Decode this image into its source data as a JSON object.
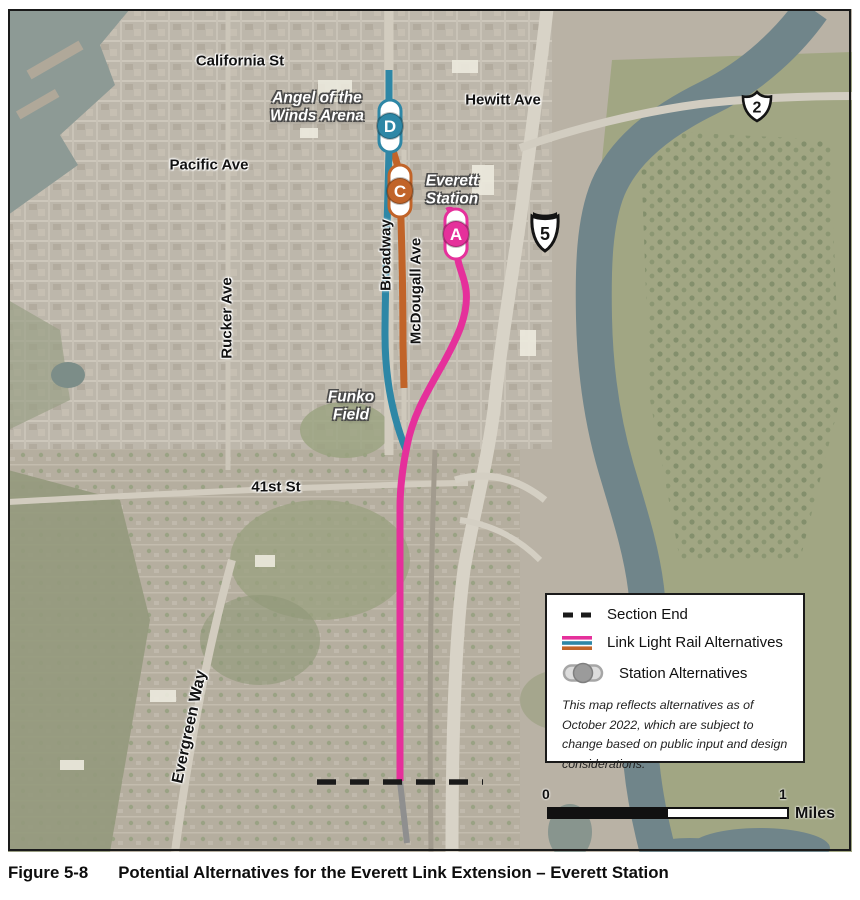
{
  "figure": {
    "label": "Figure 5-8",
    "title": "Potential Alternatives for the Everett Link Extension – Everett Station"
  },
  "map": {
    "street_labels": {
      "california_st": "California St",
      "hewitt_ave": "Hewitt Ave",
      "pacific_ave": "Pacific Ave",
      "rucker_ave": "Rucker Ave",
      "broadway": "Broadway",
      "mcdougall_ave": "McDougall Ave",
      "forty_first_st": "41st St",
      "evergreen_way": "Evergreen Way"
    },
    "place_labels": {
      "arena": {
        "line1": "Angel of the",
        "line2": "Winds Arena"
      },
      "everett_station": {
        "line1": "Everett",
        "line2": "Station"
      },
      "funko_field": {
        "line1": "Funko",
        "line2": "Field"
      }
    },
    "shields": {
      "us2": "2",
      "i5": "5"
    },
    "stations": [
      {
        "letter": "D",
        "color": "#2E87A6"
      },
      {
        "letter": "C",
        "color": "#C16429"
      },
      {
        "letter": "A",
        "color": "#E5309B"
      }
    ]
  },
  "legend": {
    "items": [
      {
        "label": "Section End"
      },
      {
        "label": "Link Light Rail Alternatives"
      },
      {
        "label": "Station Alternatives"
      }
    ],
    "station_symbol": {
      "capsule": "#dcdcdc",
      "circle": "#9b9b9b"
    },
    "note": "This map reflects alternatives as of October 2022, which are subject to change based on public input and design considerations."
  },
  "scale_bar": {
    "zero": "0",
    "one": "1",
    "unit": "Miles"
  },
  "colors": {
    "pink": "#E5309B",
    "teal": "#2E87A6",
    "orange": "#C16429",
    "section_end": "#1A1A1A",
    "route_continuation": "#8F8F8F"
  }
}
